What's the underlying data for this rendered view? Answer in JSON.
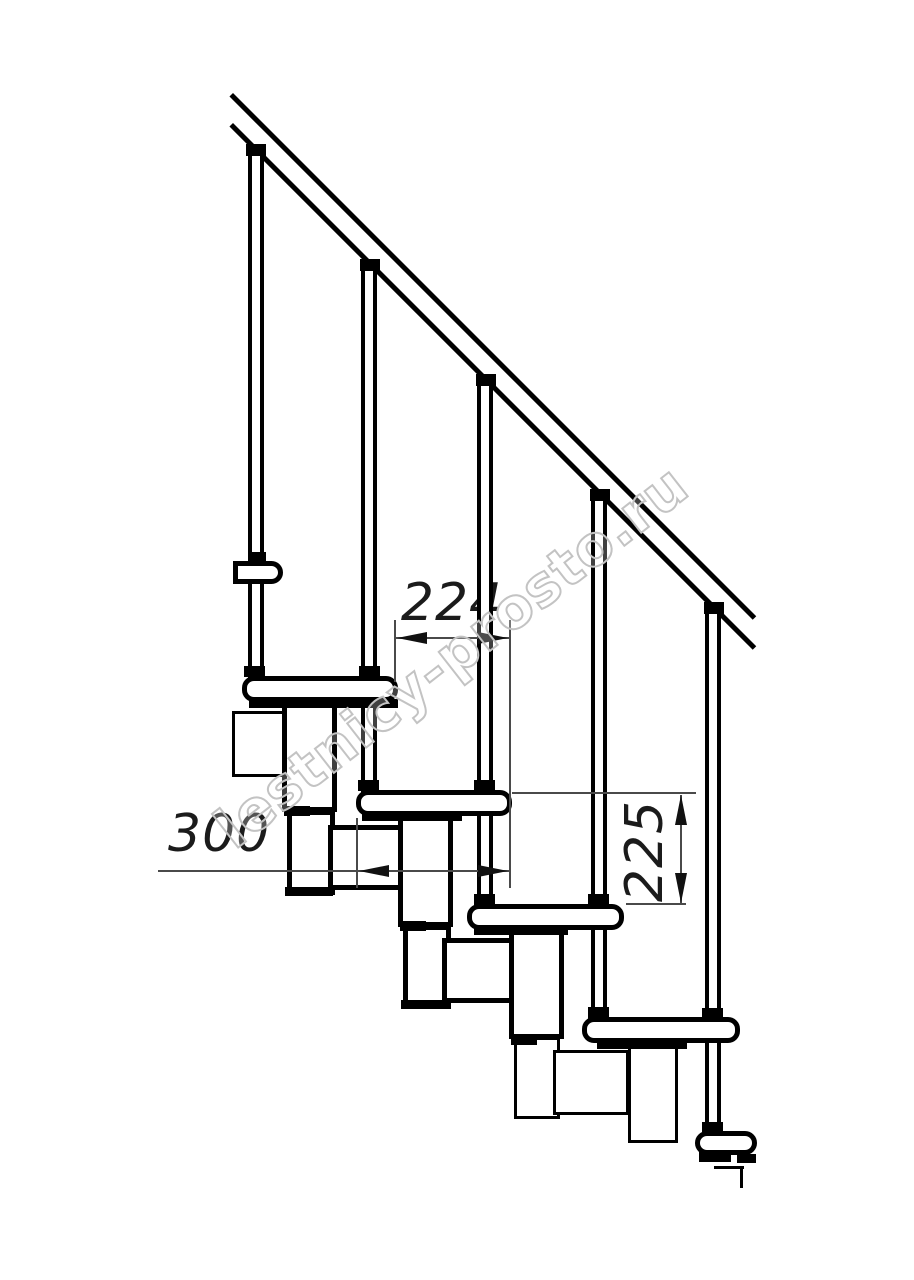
{
  "drawing": {
    "type": "technical-line-drawing",
    "subject": "side view of a modular staircase: diagonal handrail, five balusters, five treads and under-tread support modules",
    "background_color": "#ffffff",
    "line_color": "#000000",
    "dimension_line_color": "#4a4a4a",
    "text_color": "#1b1b1b",
    "watermark": {
      "text": "lestnicy-prosto.ru",
      "stroke_color": "#c3c3c3",
      "rotation_deg": -38
    },
    "dimensions": [
      {
        "label": "224",
        "orientation": "horizontal"
      },
      {
        "label": "300",
        "orientation": "horizontal"
      },
      {
        "label": "225",
        "orientation": "vertical"
      }
    ],
    "shapes": [
      [
        "rot45",
        "handrail-upper-line",
        233,
        93,
        740,
        5
      ],
      [
        "rot45",
        "handrail-lower-line",
        233,
        123,
        740,
        5
      ],
      [
        "post",
        "baluster-1",
        248,
        150,
        16,
        530
      ],
      [
        "post",
        "baluster-2",
        361,
        265,
        16,
        529
      ],
      [
        "post",
        "baluster-3",
        477,
        380,
        16,
        528
      ],
      [
        "post",
        "baluster-4",
        591,
        495,
        16,
        526
      ],
      [
        "post",
        "baluster-5",
        705,
        609,
        16,
        525
      ],
      [
        "black",
        "baluster-1-rail-cap",
        246,
        144,
        20,
        12
      ],
      [
        "black",
        "baluster-2-rail-cap",
        360,
        259,
        20,
        12
      ],
      [
        "black",
        "baluster-3-rail-cap",
        476,
        374,
        20,
        12
      ],
      [
        "black",
        "baluster-4-rail-cap",
        590,
        489,
        20,
        12
      ],
      [
        "black",
        "baluster-5-rail-cap",
        704,
        602,
        20,
        12
      ],
      [
        "black",
        "wall-bracket-collar",
        249,
        552,
        17,
        10
      ],
      [
        "roundR",
        "wall-bracket",
        233,
        561,
        50,
        23
      ],
      [
        "thin",
        "module-notch-0",
        232,
        711,
        58,
        66
      ],
      [
        "thick",
        "module-tall-1",
        282,
        700,
        55,
        112
      ],
      [
        "thick",
        "module-lower-1",
        287,
        810,
        48,
        85
      ],
      [
        "thick",
        "module-square-1",
        328,
        825,
        76,
        65
      ],
      [
        "black",
        "module-joint-1a",
        284,
        806,
        26,
        10
      ],
      [
        "black",
        "module-joint-1b",
        285,
        887,
        48,
        9
      ],
      [
        "thick",
        "module-tall-2",
        398,
        815,
        55,
        112
      ],
      [
        "thick",
        "module-lower-2",
        403,
        925,
        48,
        84
      ],
      [
        "thick",
        "module-square-2",
        442,
        938,
        76,
        65
      ],
      [
        "black",
        "module-joint-2a",
        400,
        921,
        26,
        10
      ],
      [
        "black",
        "module-joint-2b",
        401,
        1000,
        48,
        9
      ],
      [
        "thick",
        "module-tall-3",
        509,
        929,
        55,
        110
      ],
      [
        "thin",
        "module-lower-3",
        514,
        1037,
        46,
        82
      ],
      [
        "thin",
        "module-square-3",
        553,
        1050,
        76,
        65
      ],
      [
        "black",
        "module-joint-3a",
        511,
        1035,
        26,
        10
      ],
      [
        "thin",
        "module-tall-4",
        628,
        1043,
        50,
        100
      ],
      [
        "black",
        "step-profile-h",
        714,
        1166,
        30,
        3
      ],
      [
        "black",
        "step-profile-v",
        740,
        1166,
        3,
        22
      ],
      [
        "tread",
        "tread-1",
        242,
        676,
        156,
        26
      ],
      [
        "tread",
        "tread-2",
        356,
        790,
        156,
        26
      ],
      [
        "tread",
        "tread-3",
        467,
        904,
        157,
        26
      ],
      [
        "tread",
        "tread-4",
        582,
        1017,
        158,
        26
      ],
      [
        "tread",
        "tread-5",
        695,
        1131,
        62,
        24
      ],
      [
        "black",
        "tread-1-strip",
        249,
        699,
        149,
        9
      ],
      [
        "black",
        "tread-2-strip",
        362,
        813,
        100,
        8
      ],
      [
        "black",
        "tread-3-strip",
        474,
        927,
        94,
        8
      ],
      [
        "black",
        "tread-4-strip",
        597,
        1041,
        90,
        8
      ],
      [
        "black",
        "tread-5-foot-a",
        699,
        1152,
        32,
        10
      ],
      [
        "black",
        "tread-5-foot-b",
        737,
        1154,
        19,
        9
      ],
      [
        "black",
        "collar-t1-left",
        244,
        666,
        21,
        11
      ],
      [
        "black",
        "collar-t1-right",
        359,
        666,
        21,
        11
      ],
      [
        "black",
        "collar-t2-left",
        358,
        780,
        21,
        11
      ],
      [
        "black",
        "collar-t2-right",
        474,
        780,
        21,
        11
      ],
      [
        "black",
        "collar-t3-left",
        474,
        894,
        21,
        11
      ],
      [
        "black",
        "collar-t3-right",
        588,
        894,
        21,
        11
      ],
      [
        "black",
        "collar-t4-left",
        588,
        1007,
        21,
        12
      ],
      [
        "black",
        "collar-t4-right",
        702,
        1008,
        21,
        12
      ],
      [
        "black",
        "collar-t5",
        702,
        1122,
        21,
        10
      ],
      [
        "hair",
        "dim224-line",
        395,
        637,
        115,
        2
      ],
      [
        "hair",
        "dim224-ext-left",
        394,
        620,
        2,
        62
      ],
      [
        "hair",
        "dim-shared-ext-right",
        509,
        620,
        2,
        268
      ],
      [
        "arrow-l",
        "dim224-arrow-left",
        397,
        638,
        0,
        0
      ],
      [
        "arrow-r",
        "dim224-arrow-right",
        508,
        638,
        0,
        0
      ],
      [
        "hair",
        "dim300-line",
        158,
        870,
        352,
        2
      ],
      [
        "hair",
        "dim300-ext-left",
        356,
        818,
        2,
        70
      ],
      [
        "arrow-l",
        "dim300-arrow-left",
        359,
        871,
        0,
        0
      ],
      [
        "arrow-r",
        "dim300-arrow-right",
        508,
        871,
        0,
        0
      ],
      [
        "hair",
        "dim225-line",
        680,
        795,
        2,
        108
      ],
      [
        "hair",
        "dim225-ext-top",
        512,
        792,
        184,
        2
      ],
      [
        "hair",
        "dim225-ext-bottom",
        626,
        903,
        60,
        2
      ],
      [
        "arrow-u",
        "dim225-arrow-top",
        681,
        795,
        0,
        0
      ],
      [
        "arrow-d",
        "dim225-arrow-bottom",
        681,
        903,
        0,
        0
      ]
    ]
  }
}
